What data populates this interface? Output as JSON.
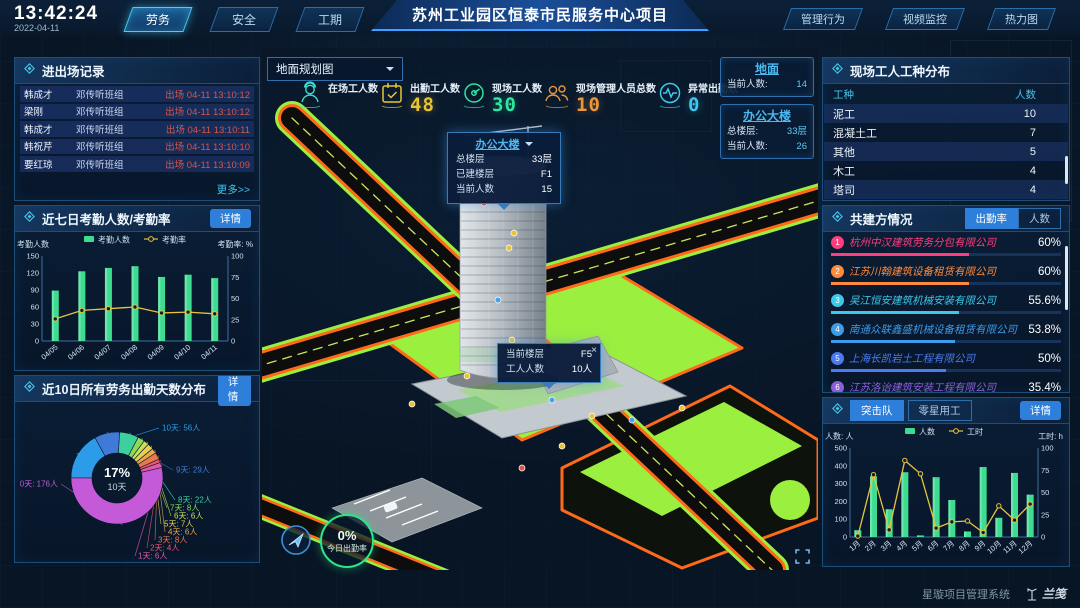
{
  "header": {
    "time": "13:42:24",
    "date": "2022-04-11",
    "tabs_left": [
      {
        "label": "劳务",
        "active": true
      },
      {
        "label": "安全",
        "active": false
      },
      {
        "label": "工期",
        "active": false
      }
    ],
    "title": "苏州工业园区恒泰市民服务中心项目",
    "tabs_right": [
      "管理行为",
      "视频监控",
      "热力图"
    ]
  },
  "entry_exit": {
    "title": "进出场记录",
    "rows": [
      {
        "name": "韩成才",
        "group": "邓传听班组",
        "event": "出场 04-11 13:10:12"
      },
      {
        "name": "梁刚",
        "group": "邓传听班组",
        "event": "出场 04-11 13:10:12"
      },
      {
        "name": "韩成才",
        "group": "邓传听班组",
        "event": "出场 04-11 13:10:11"
      },
      {
        "name": "韩祝芹",
        "group": "邓传听班组",
        "event": "出场 04-11 13:10:10"
      },
      {
        "name": "要红琼",
        "group": "邓传听班组",
        "event": "出场 04-11 13:10:09"
      }
    ],
    "more": "更多>>"
  },
  "attendance_panel": {
    "title": "近七日考勤人数/考勤率",
    "detail": "详情"
  },
  "distribution_panel": {
    "title": "近10日所有劳务出勤天数分布",
    "detail": "详情"
  },
  "map": {
    "view_selector": "地面规划图",
    "stats": [
      {
        "icon": "worker-icon",
        "label": "在场工人数",
        "value": "",
        "color": "#35e0cf"
      },
      {
        "icon": "calendar-icon",
        "label": "出勤工人数",
        "value": "48",
        "color": "#e8c434"
      },
      {
        "icon": "gauge-icon",
        "label": "现场工人数",
        "value": "30",
        "color": "#2ee6a0"
      },
      {
        "icon": "people-icon",
        "label": "现场管理人员总数",
        "value": "10",
        "color": "#e8973c"
      },
      {
        "icon": "pulse-icon",
        "label": "异常出勤数",
        "value": "0",
        "color": "#3cc8f0"
      }
    ],
    "building_tooltip": {
      "title": "办公大楼",
      "rows": [
        [
          "总楼层",
          "33层"
        ],
        [
          "已建楼层",
          "F1"
        ],
        [
          "当前人数",
          "15"
        ]
      ]
    },
    "floor_tooltip": {
      "rows": [
        [
          "当前楼层",
          "F5"
        ],
        [
          "工人人数",
          "10人"
        ]
      ],
      "close": "×"
    },
    "floor_boxes": [
      {
        "title": "地面",
        "rows": [
          [
            "当前人数:",
            "14"
          ]
        ]
      },
      {
        "title": "办公大楼",
        "rows": [
          [
            "总楼层:",
            "33层"
          ],
          [
            "当前人数:",
            "26"
          ]
        ]
      }
    ],
    "attendance_ring": {
      "value": "0%",
      "label": "今日出勤率"
    }
  },
  "worker_types": {
    "title": "现场工人工种分布",
    "headers": [
      "工种",
      "人数"
    ],
    "rows": [
      [
        "泥工",
        "10"
      ],
      [
        "混凝土工",
        "7"
      ],
      [
        "其他",
        "5"
      ],
      [
        "木工",
        "4"
      ],
      [
        "塔司",
        "4"
      ]
    ]
  },
  "partners": {
    "title": "共建方情况",
    "tabs": [
      "出勤率",
      "人数"
    ],
    "active_tab": 0,
    "items": [
      {
        "rank": "1",
        "name": "杭州中汉建筑劳务分包有限公司",
        "value": "60%",
        "pct": 60,
        "color": "#ff3d7f"
      },
      {
        "rank": "2",
        "name": "江苏川翰建筑设备租赁有限公司",
        "value": "60%",
        "pct": 60,
        "color": "#ff8a3d"
      },
      {
        "rank": "3",
        "name": "吴江恒安建筑机械安装有限公司",
        "value": "55.6%",
        "pct": 55.6,
        "color": "#3dc8e8"
      },
      {
        "rank": "4",
        "name": "南通众联鑫盛机械设备租赁有限公司",
        "value": "53.8%",
        "pct": 53.8,
        "color": "#3d9be8"
      },
      {
        "rank": "5",
        "name": "上海长凯岩土工程有限公司",
        "value": "50%",
        "pct": 50,
        "color": "#4a7bf0"
      },
      {
        "rank": "6",
        "name": "江苏洛诒建筑安装工程有限公司",
        "value": "35.4%",
        "pct": 35.4,
        "color": "#8a5fd6"
      }
    ]
  },
  "team_panel": {
    "tabs": [
      "突击队",
      "零星用工"
    ],
    "active_tab": 0,
    "detail": "详情"
  },
  "footer": {
    "system": "星璇项目管理系统",
    "brand": "兰笺"
  },
  "chart_data": [
    {
      "type": "bar",
      "title": "近七日考勤人数/考勤率",
      "categories": [
        "04/05",
        "04/06",
        "04/07",
        "04/08",
        "04/09",
        "04/10",
        "04/11"
      ],
      "series": [
        {
          "name": "考勤人数",
          "type": "bar",
          "color": "#3ddc91",
          "axis": "left",
          "values": [
            89,
            123,
            129,
            132,
            113,
            117,
            111
          ]
        },
        {
          "name": "考勤率",
          "type": "line",
          "color": "#e8c43c",
          "axis": "right",
          "values": [
            26,
            36,
            38,
            40,
            33,
            34,
            32
          ]
        }
      ],
      "left_axis": {
        "label": "考勤人数",
        "max": 150,
        "ticks": [
          0,
          30,
          60,
          90,
          120,
          150
        ]
      },
      "right_axis": {
        "label": "考勤率: %",
        "max": 100,
        "ticks": [
          0,
          25,
          50,
          75,
          100
        ]
      },
      "grid": false,
      "legend_position": "top"
    },
    {
      "type": "pie",
      "title": "近10日所有劳务出勤天数分布",
      "center": {
        "percent": "17%",
        "label": "10天"
      },
      "slices": [
        {
          "name": "10天",
          "people": 56,
          "label": "10天: 56人",
          "color": "#2d9ce8"
        },
        {
          "name": "9天",
          "people": 29,
          "label": "9天: 29人",
          "color": "#3f7ad8"
        },
        {
          "name": "8天",
          "people": 22,
          "label": "8天: 22人",
          "color": "#3ecf9e"
        },
        {
          "name": "7天",
          "people": 8,
          "label": "7天: 8人",
          "color": "#8ed85a"
        },
        {
          "name": "6天",
          "people": 6,
          "label": "6天: 6人",
          "color": "#c8e05a"
        },
        {
          "name": "5天",
          "people": 7,
          "label": "5天: 7人",
          "color": "#e8d052"
        },
        {
          "name": "4天",
          "people": 6,
          "label": "4天: 6人",
          "color": "#e8a84e"
        },
        {
          "name": "3天",
          "people": 8,
          "label": "3天: 8人",
          "color": "#e8784e"
        },
        {
          "name": "2天",
          "people": 4,
          "label": "2天: 4人",
          "color": "#e85a78"
        },
        {
          "name": "1天",
          "people": 6,
          "label": "1天: 6人",
          "color": "#e858a8"
        },
        {
          "name": "0天",
          "people": 176,
          "label": "0天: 176人",
          "color": "#c45ad8"
        }
      ]
    },
    {
      "type": "bar",
      "title": "突击队月度人数/工时",
      "categories": [
        "1月",
        "2月",
        "3月",
        "4月",
        "5月",
        "6月",
        "7月",
        "8月",
        "9月",
        "10月",
        "11月",
        "12月"
      ],
      "series": [
        {
          "name": "人数",
          "type": "bar",
          "color": "#3ddc91",
          "axis": "left",
          "values": [
            38,
            341,
            156,
            364,
            9,
            336,
            208,
            31,
            393,
            108,
            360,
            238
          ]
        },
        {
          "name": "工时",
          "type": "line",
          "color": "#e8c43c",
          "axis": "right",
          "values": [
            1,
            70,
            8,
            86,
            71,
            10,
            17,
            18,
            5,
            35,
            19,
            37
          ]
        }
      ],
      "left_axis": {
        "label": "人数: 人",
        "max": 500,
        "ticks": [
          0,
          100,
          200,
          300,
          400,
          500
        ]
      },
      "right_axis": {
        "label": "工时: h",
        "max": 100,
        "ticks": [
          0,
          25,
          50,
          75,
          100
        ]
      },
      "grid": false,
      "legend_position": "top"
    }
  ]
}
